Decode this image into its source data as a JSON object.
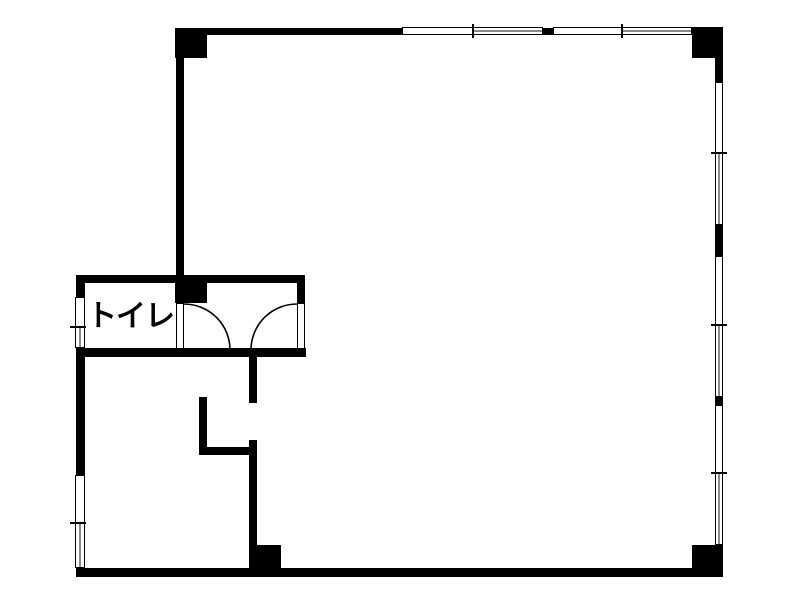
{
  "rooms": {
    "toilet": {
      "label": "トイレ"
    }
  },
  "colors": {
    "wall": "#000000",
    "background": "#ffffff",
    "window_glass": "#ffffff",
    "window_sash_line": "#8a8a8a"
  }
}
